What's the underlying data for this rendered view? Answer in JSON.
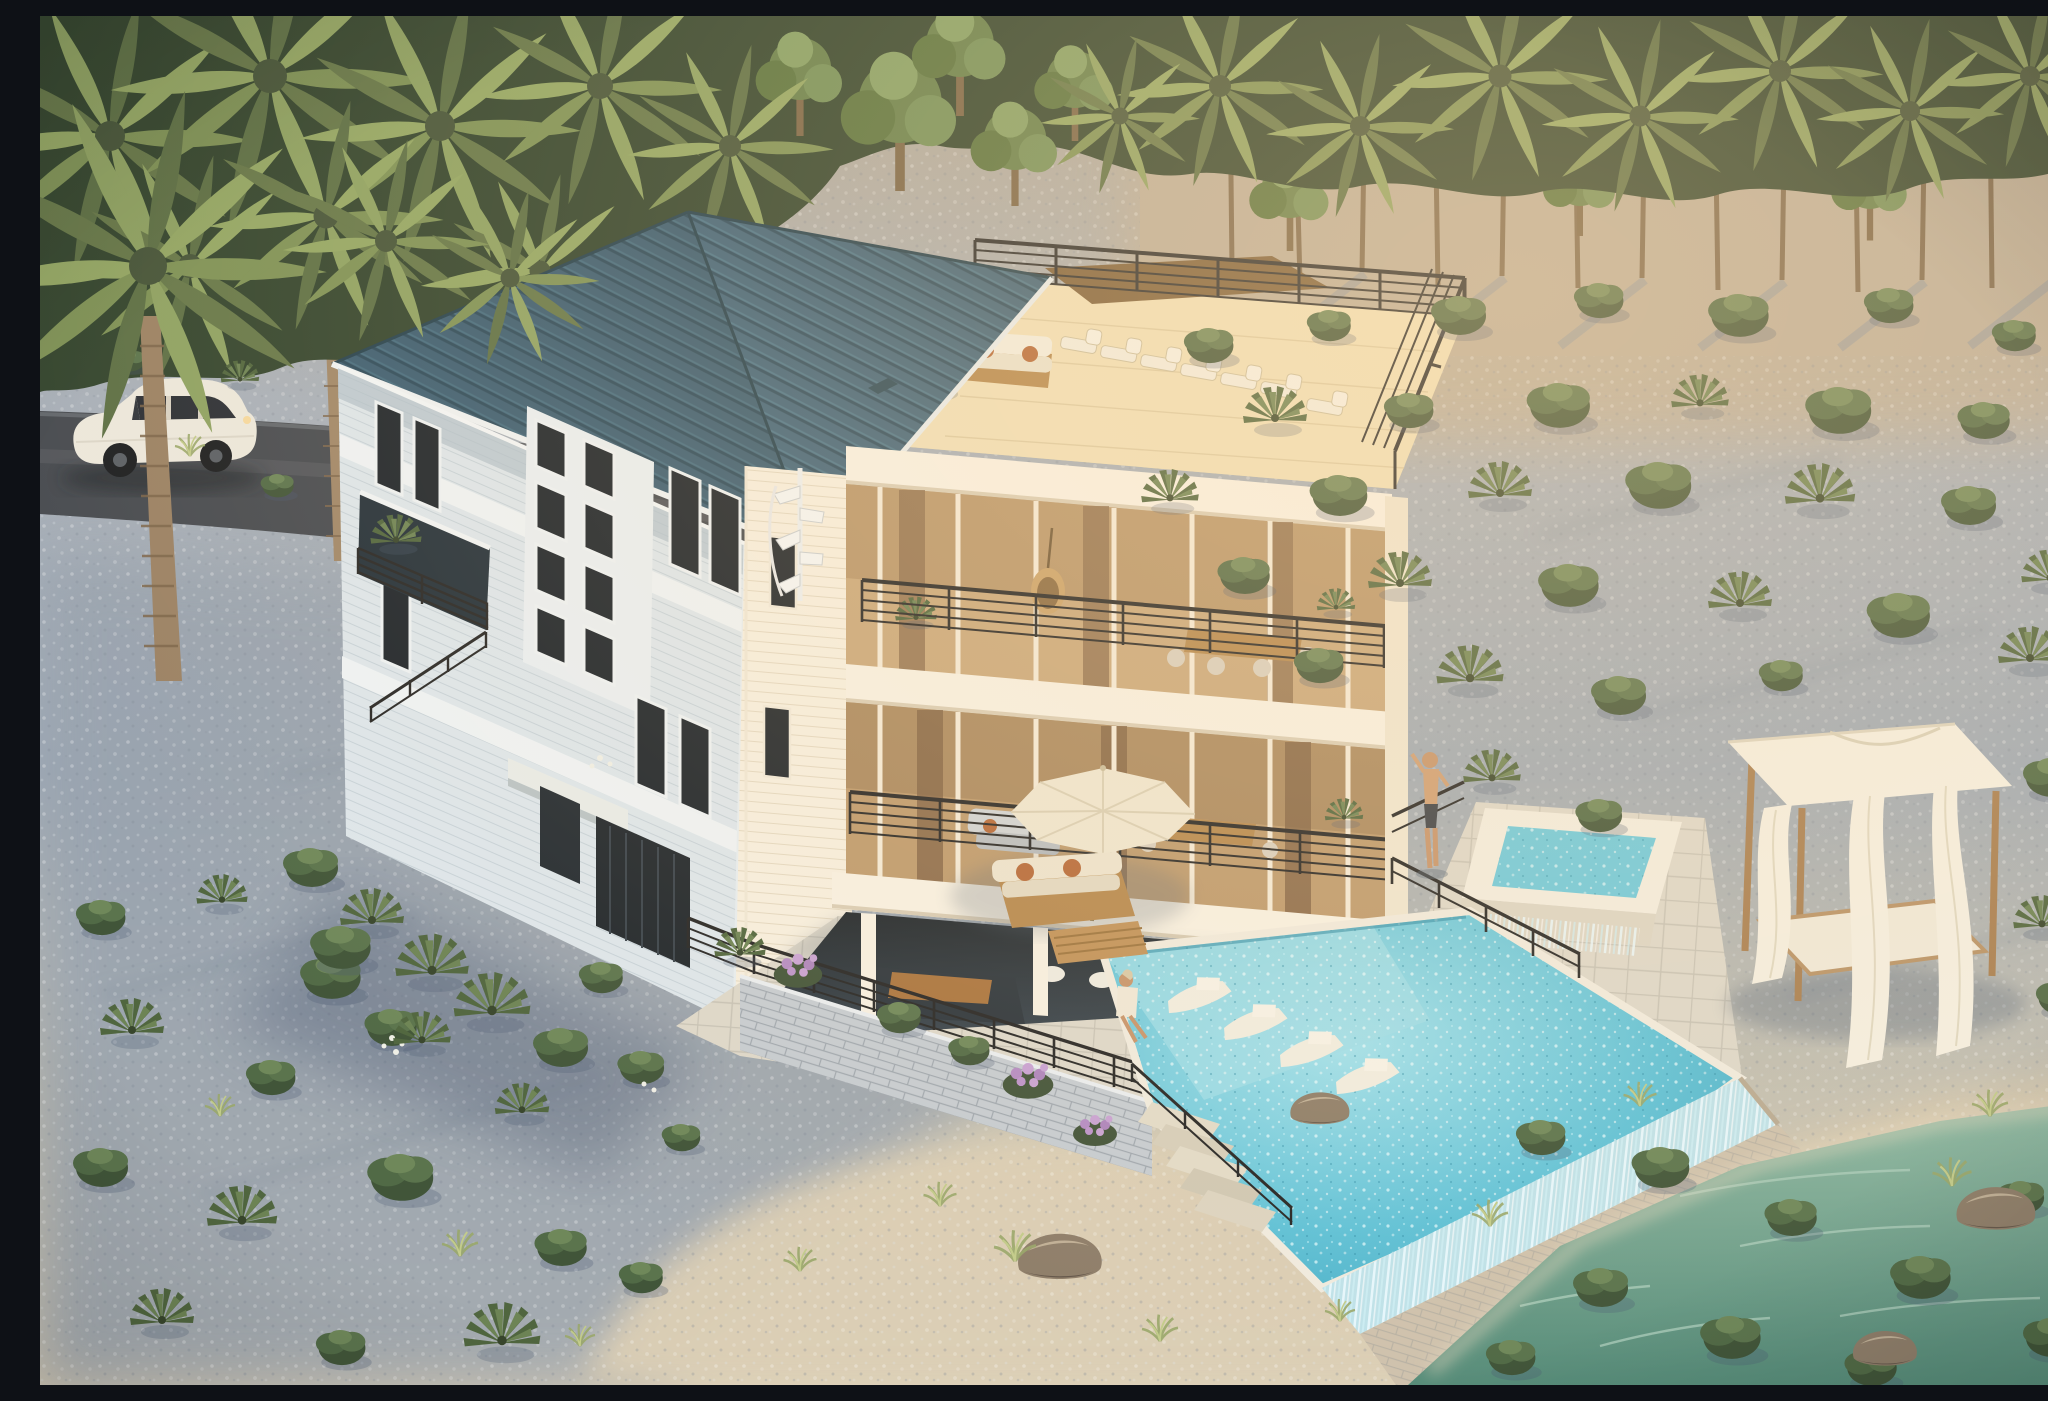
{
  "scene": {
    "type": "architectural-aerial-rendering",
    "title": "Aerial golden-hour rendering of a three-story white coastal beach house with teal metal roof, rooftop deck, infinity pool and spa, set in gravel dunes with palms",
    "time_of_day": "golden hour",
    "people_count": 2,
    "palette": {
      "roof_teal": "#41647a",
      "roof_seam_dark": "#2e4d60",
      "siding_cool_white": "#dde6ec",
      "siding_warm_white": "#f6efe0",
      "railing_black": "#2a2a2a",
      "pool_turquoise": "#57bcd4",
      "spa_turquoise": "#6ecadd",
      "gravel_blue_gray": "#a6afba",
      "gravel_warm": "#bcae9a",
      "sand_warm": "#d9cdb4",
      "lagoon_green": "#74a892",
      "road_asphalt": "#474b51",
      "vegetation_dark": "#415539",
      "vegetation_light": "#8da065",
      "wood_furniture": "#b5884f",
      "car_white": "#ece8dd",
      "cabana_canvas": "#f4efe2"
    },
    "elements": [
      {
        "name": "beach-house",
        "description": "three-story white coastal home with teal standing-seam hip roof"
      },
      {
        "name": "rooftop-deck",
        "description": "railed roof terrace with sun loungers, white sofa and potted plants"
      },
      {
        "name": "upper-balcony",
        "description": "third-floor covered balcony with dining table, hanging egg chair and planters"
      },
      {
        "name": "lower-balcony",
        "description": "second-floor covered balcony with lounge seating"
      },
      {
        "name": "ground-patio",
        "description": "open ground level with outdoor dining and white stools"
      },
      {
        "name": "infinity-pool",
        "description": "turquoise pool with in-water loungers and waterfall edge"
      },
      {
        "name": "spa",
        "description": "raised square hot tub spilling into the pool"
      },
      {
        "name": "pool-deck",
        "description": "stone paver deck with cream umbrella, teak sofa set and coffee table"
      },
      {
        "name": "cabana-daybed",
        "description": "teak daybed with white canopy and wind-blown curtains"
      },
      {
        "name": "suv",
        "description": "white SUV parked on the asphalt drive beneath palms"
      },
      {
        "name": "palm-canopy",
        "description": "dense palm and hardwood canopy across the top of the site"
      },
      {
        "name": "tree-grove",
        "description": "palm grove with visible trunks and long shadows on warm gravel"
      },
      {
        "name": "shrub-field",
        "description": "rows of round shrubs and palmetto plants on blue-gray gravel"
      },
      {
        "name": "beach-sand",
        "description": "pale sand foreground with rocks and grass tufts"
      },
      {
        "name": "lagoon",
        "description": "shallow green water with emergent bushes at lower right"
      },
      {
        "name": "people",
        "description": "man standing near the spa, woman seated at the pool edge"
      }
    ]
  }
}
